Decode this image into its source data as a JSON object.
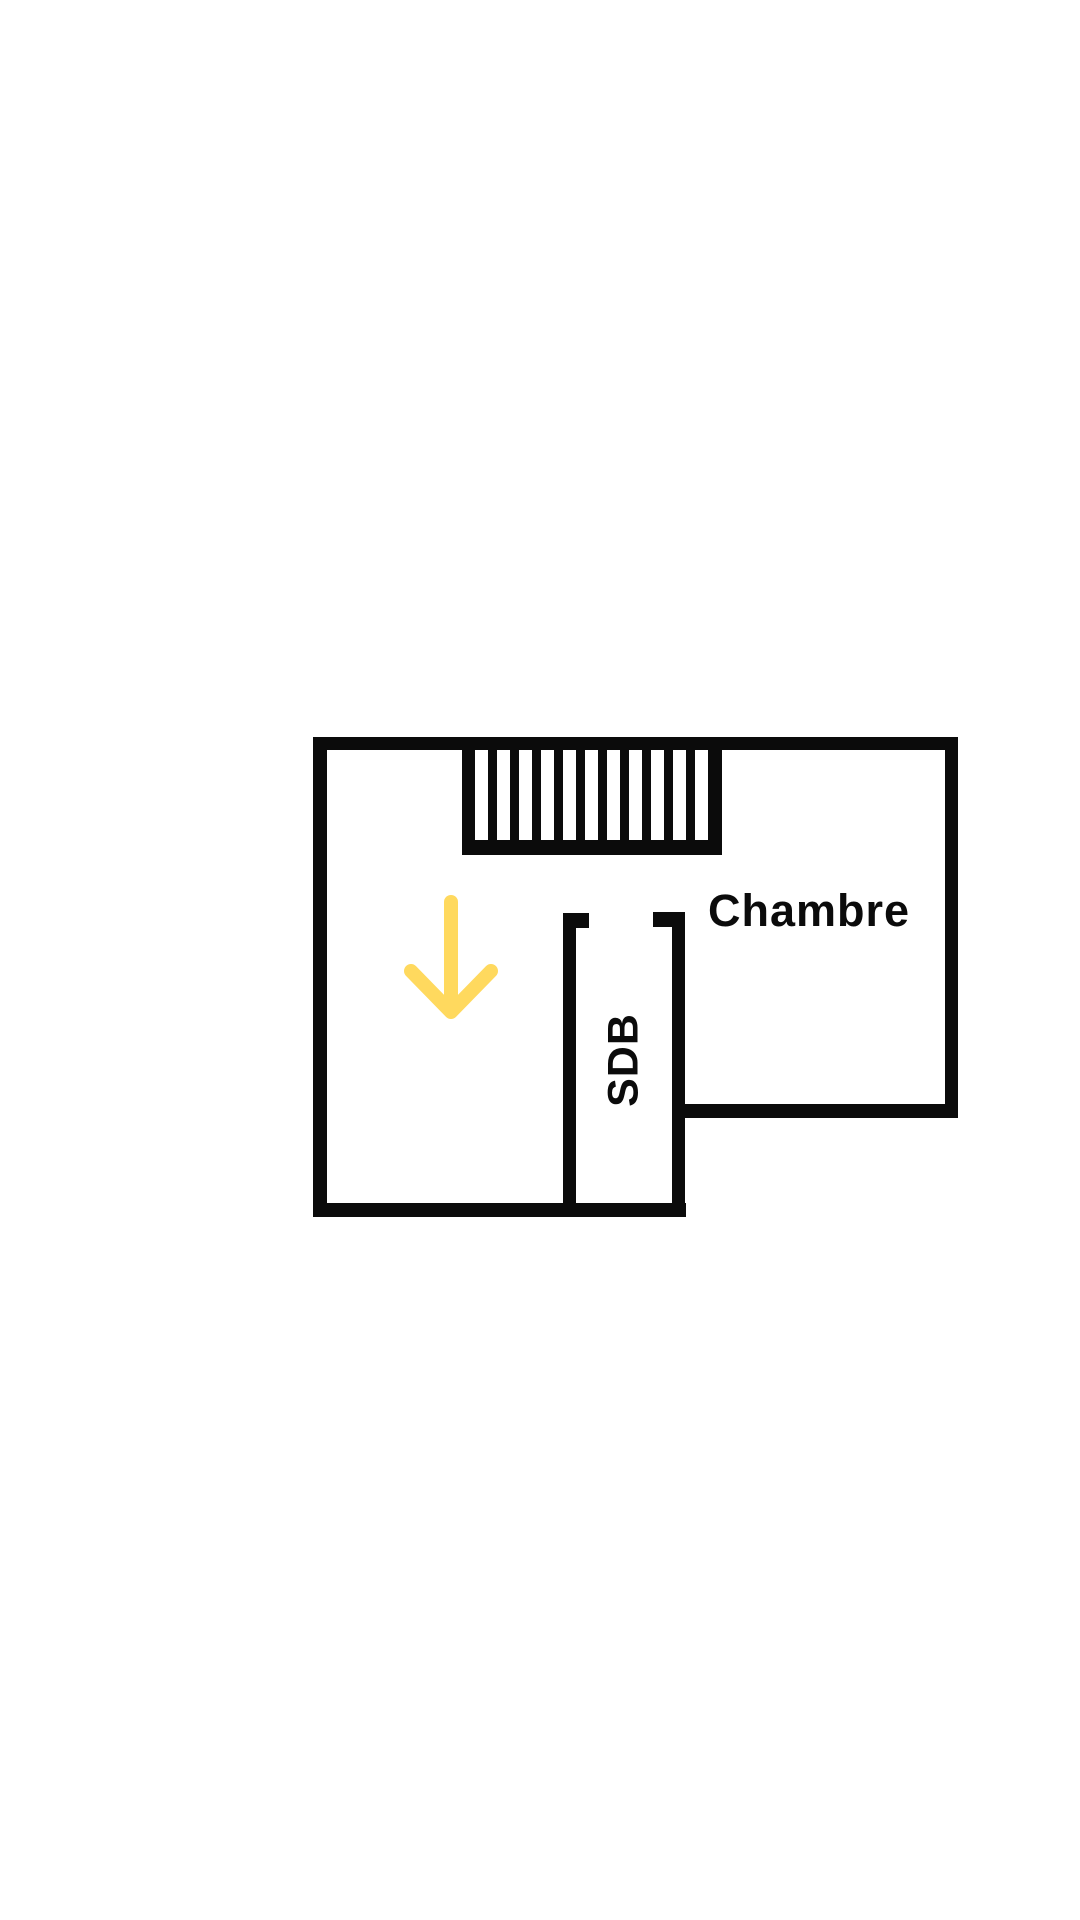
{
  "page": {
    "background": "#ffffff"
  },
  "plan": {
    "wall_color": "#0b0b0b",
    "rooms": {
      "chambre_label": "Chambre",
      "sdb_label": "SDB"
    },
    "stairs": {
      "tread_count": 10
    },
    "arrow": {
      "color": "#ffd95e",
      "direction": "down"
    }
  }
}
